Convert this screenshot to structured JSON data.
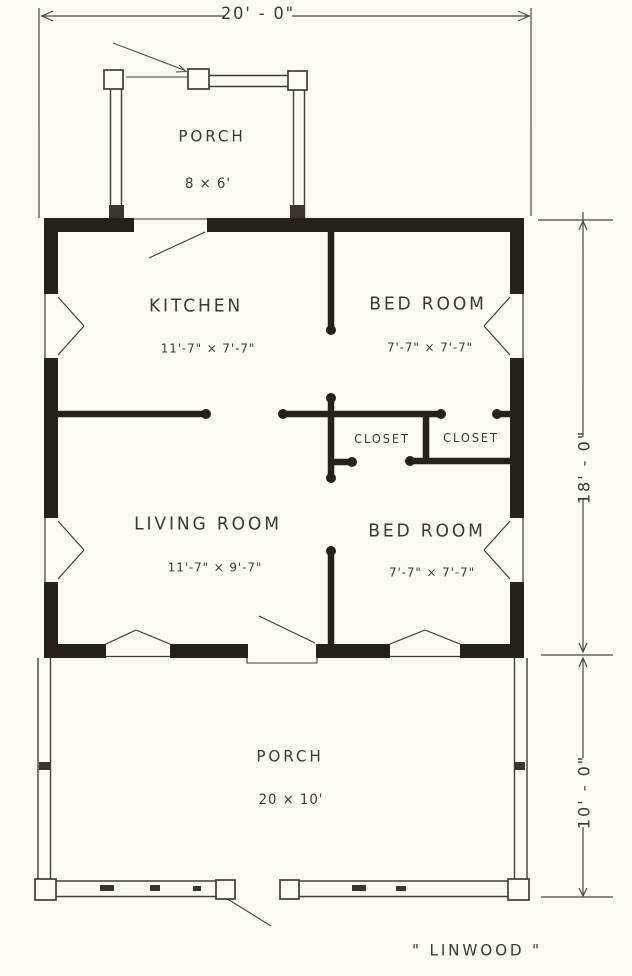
{
  "meta": {
    "drawing_type": "house floor plan",
    "plan_title": "\" LINWOOD \""
  },
  "colors": {
    "ink": "#2c2823",
    "wall": "#262119",
    "paper": "#fbfaf5"
  },
  "dimensions": {
    "overall_width": "20' - 0\"",
    "house_depth": "18' - 0\"",
    "front_porch_depth": "10' - 0\""
  },
  "rooms": {
    "porch_top": {
      "label": "PORCH",
      "size": "8 × 6'"
    },
    "kitchen": {
      "label": "KITCHEN",
      "size": "11'-7\" × 7'-7\""
    },
    "bedroom_top": {
      "label": "BED ROOM",
      "size": "7'-7\" × 7'-7\""
    },
    "living_room": {
      "label": "LIVING ROOM",
      "size": "11'-7\" × 9'-7\""
    },
    "bedroom_bottom": {
      "label": "BED ROOM",
      "size": "7'-7\" × 7'-7\""
    },
    "closet_left": {
      "label": "CLOSET"
    },
    "closet_right": {
      "label": "CLOSET"
    },
    "porch_bottom": {
      "label": "PORCH",
      "size": "20 × 10'"
    }
  }
}
